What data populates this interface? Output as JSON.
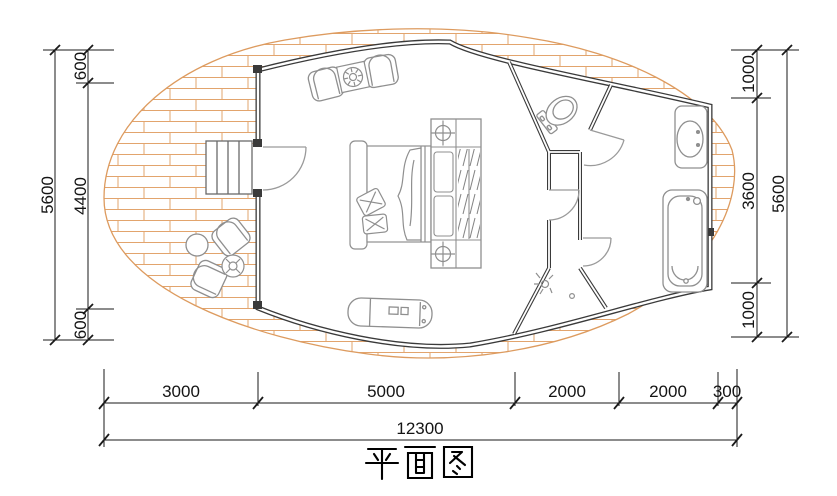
{
  "title": {
    "text": "平面图"
  },
  "dimensions": {
    "left": {
      "total": "5600",
      "segments": [
        "600",
        "4400",
        "600"
      ]
    },
    "right": {
      "total": "5600",
      "segments": [
        "1000",
        "3600",
        "1000"
      ]
    },
    "bottom": {
      "segments": [
        "3000",
        "5000",
        "2000",
        "2000",
        "300"
      ],
      "total": "12300"
    }
  },
  "colors": {
    "deck_hatch": "#e2a46d",
    "walls": "#3a3a3a",
    "furniture": "#8f8f8f",
    "doors": "#9a9a9a",
    "dimension_lines": "#1a1a1a"
  },
  "fixtures": [
    "wood-deck",
    "entry-steps",
    "entry-door",
    "armchair-pair-with-stove-table",
    "double-bed",
    "wardrobe-with-spotlights",
    "chaise-lounge",
    "outdoor-armchairs-with-side-tables",
    "toilet-room",
    "corridor",
    "shower-room",
    "washbasin",
    "bathtub"
  ]
}
